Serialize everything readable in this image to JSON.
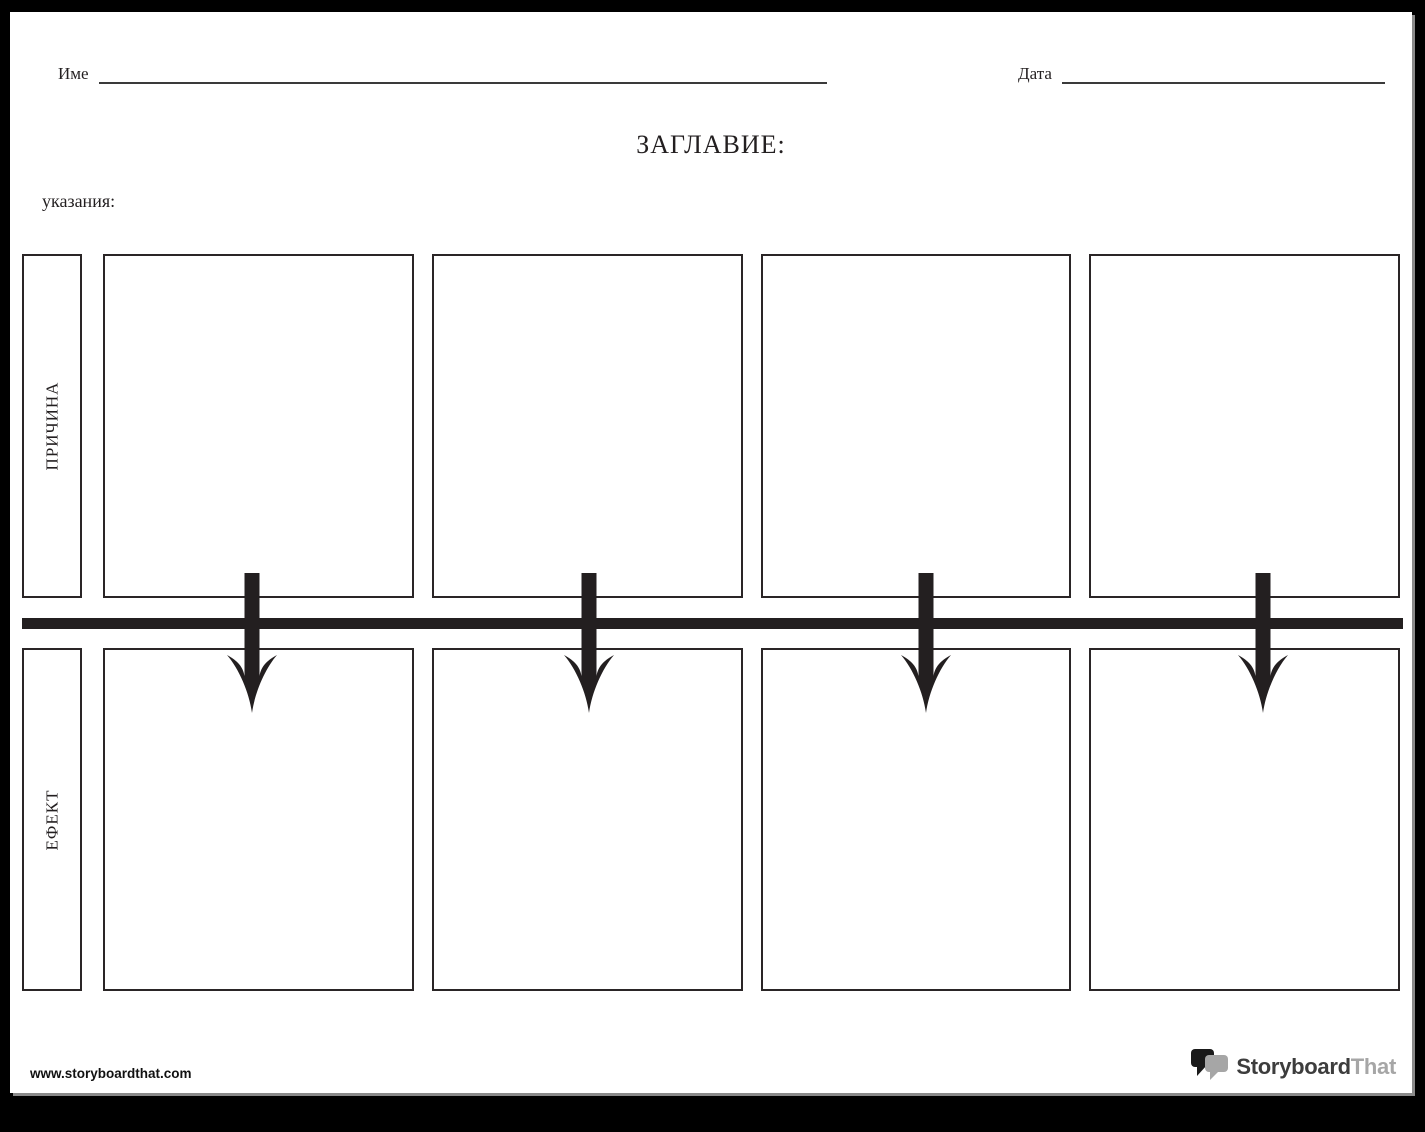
{
  "header": {
    "name_label": "Име",
    "name_value": "",
    "date_label": "Дата",
    "date_value": ""
  },
  "title": {
    "label": "ЗАГЛАВИЕ:"
  },
  "instructions": {
    "label": "указания:",
    "value": ""
  },
  "grid": {
    "cause": {
      "label": "ПРИЧИНА",
      "cell_count": 4,
      "cell_values": [
        "",
        "",
        "",
        ""
      ]
    },
    "effect": {
      "label": "ЕФЕКТ",
      "cell_count": 4,
      "cell_values": [
        "",
        "",
        "",
        ""
      ]
    }
  },
  "arrows": {
    "count": 4,
    "direction": "down"
  },
  "footer": {
    "website": "www.storyboardthat.com",
    "logo_text_primary": "Storyboard",
    "logo_text_secondary": "That"
  },
  "colors": {
    "ink": "#231f20",
    "box_border": "#2a2526",
    "page_background": "#ffffff",
    "frame_background": "#000000",
    "logo_dark": "#3d3d3d",
    "logo_gray": "#a6a6a6"
  }
}
